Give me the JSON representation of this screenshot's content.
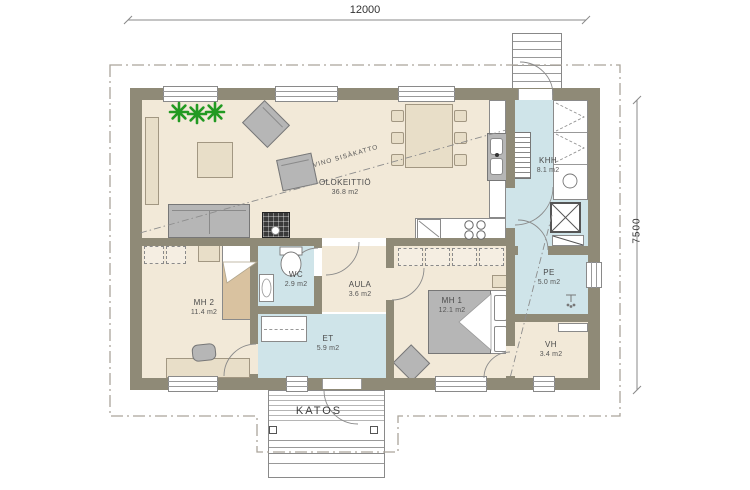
{
  "dimensions": {
    "width": "12000",
    "height": "7500"
  },
  "annotations": {
    "sloped_ceiling": "VINO SISÄKATTO",
    "porch": "KATOS"
  },
  "rooms": {
    "olokeittio": {
      "name": "OLOKEITTIÖ",
      "area": "36.8 m2"
    },
    "khh": {
      "name": "KHH",
      "area": "8.1 m2"
    },
    "wc": {
      "name": "WC",
      "area": "2.9 m2"
    },
    "aula": {
      "name": "AULA",
      "area": "3.6 m2"
    },
    "mh2": {
      "name": "MH 2",
      "area": "11.4 m2"
    },
    "mh1": {
      "name": "MH 1",
      "area": "12.1 m2"
    },
    "et": {
      "name": "ET",
      "area": "5.9 m2"
    },
    "pe": {
      "name": "PE",
      "area": "5.0 m2"
    },
    "vh": {
      "name": "VH",
      "area": "3.4 m2"
    }
  },
  "colors": {
    "wall": "#8f8a77",
    "floor": "#f2e9d8",
    "wet_floor": "#cfe4e9",
    "plant_green": "#229a22"
  }
}
